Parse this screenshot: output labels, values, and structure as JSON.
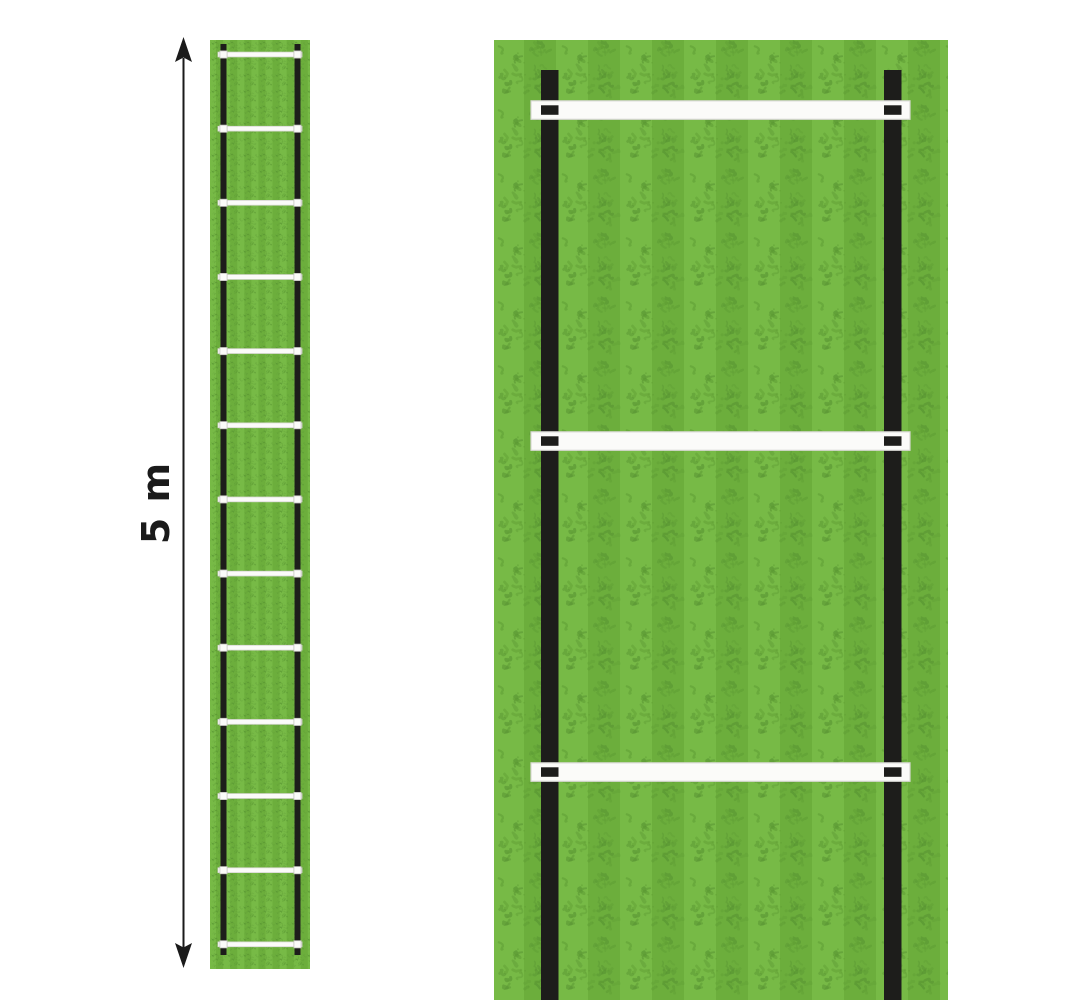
{
  "dimension": {
    "label": "5 m"
  },
  "overview_ladder": {
    "rung_count": 13,
    "rail_count": 2
  },
  "closeup_ladder": {
    "visible_rung_count": 3,
    "rail_count": 2
  },
  "colors": {
    "background": "#ffffff",
    "grass_light": "#77ba46",
    "grass_dark": "#6cae3c",
    "grass_speckle": "#5f9e34",
    "grass_speckle_dark": "#569231",
    "rail": "#1d1d1b",
    "rung_fill": "#fbfbf9",
    "rung_border": "#d8d8d2",
    "clip_black": "#1d1d1b",
    "clip_light_border": "#c4c4be",
    "arrow": "#1a1a1a"
  }
}
